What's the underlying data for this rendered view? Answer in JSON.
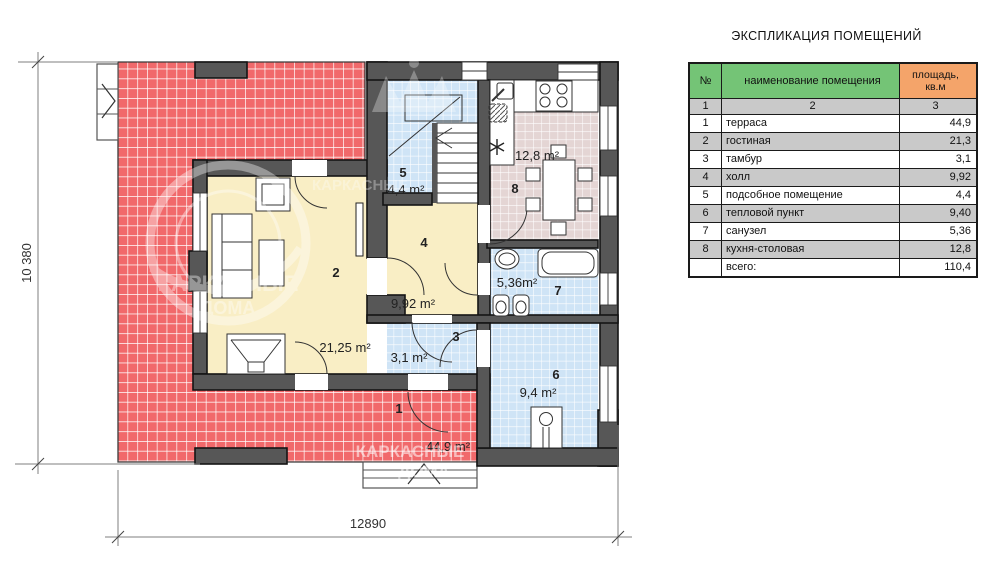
{
  "title": {
    "text": "ЭКСПЛИКАЦИЯ ПОМЕЩЕНИЙ"
  },
  "table": {
    "headers": {
      "num": "№",
      "name": "наименование помещения",
      "area_line1": "площадь,",
      "area_line2": "кв.м"
    },
    "col_numbers": [
      "1",
      "2",
      "3"
    ],
    "rows": [
      {
        "num": "1",
        "name": "терраса",
        "area": "44,9"
      },
      {
        "num": "2",
        "name": "гостиная",
        "area": "21,3"
      },
      {
        "num": "3",
        "name": "тамбур",
        "area": "3,1"
      },
      {
        "num": "4",
        "name": "холл",
        "area": "9,92"
      },
      {
        "num": "5",
        "name": "подсобное помещение",
        "area": "4,4"
      },
      {
        "num": "6",
        "name": "тепловой пункт",
        "area": "9,40"
      },
      {
        "num": "7",
        "name": "санузел",
        "area": "5,36"
      },
      {
        "num": "8",
        "name": "кухня-столовая",
        "area": "12,8"
      },
      {
        "num": "",
        "name": "всего:",
        "area": "110,4"
      }
    ]
  },
  "plan": {
    "rooms": [
      {
        "num": "1",
        "area": "44,9 m²"
      },
      {
        "num": "2",
        "area": "21,25 m²"
      },
      {
        "num": "3",
        "area": "3,1 m²"
      },
      {
        "num": "4",
        "area": "9,92 m²"
      },
      {
        "num": "5",
        "area": "4,4 m²"
      },
      {
        "num": "6",
        "area": "9,4 m²"
      },
      {
        "num": "7",
        "area": "5,36m²"
      },
      {
        "num": "8",
        "area": "12,8 m²"
      }
    ],
    "dimensions": {
      "height": "10 380",
      "width": "12890"
    },
    "watermark": {
      "brand1": "КАРКАСНЫЕ",
      "brand2": "ДОМА"
    }
  },
  "colors": {
    "terrace_red": "#f1696b",
    "room_yellow": "#f9eec5",
    "room_blue": "#cfe4f6",
    "kitchen_mauve": "#e4d5d4",
    "wall_gray": "#575757",
    "table_header_green": "#74c476",
    "table_header_orange": "#f4a46a",
    "table_row_gray": "#c9c9c9"
  }
}
